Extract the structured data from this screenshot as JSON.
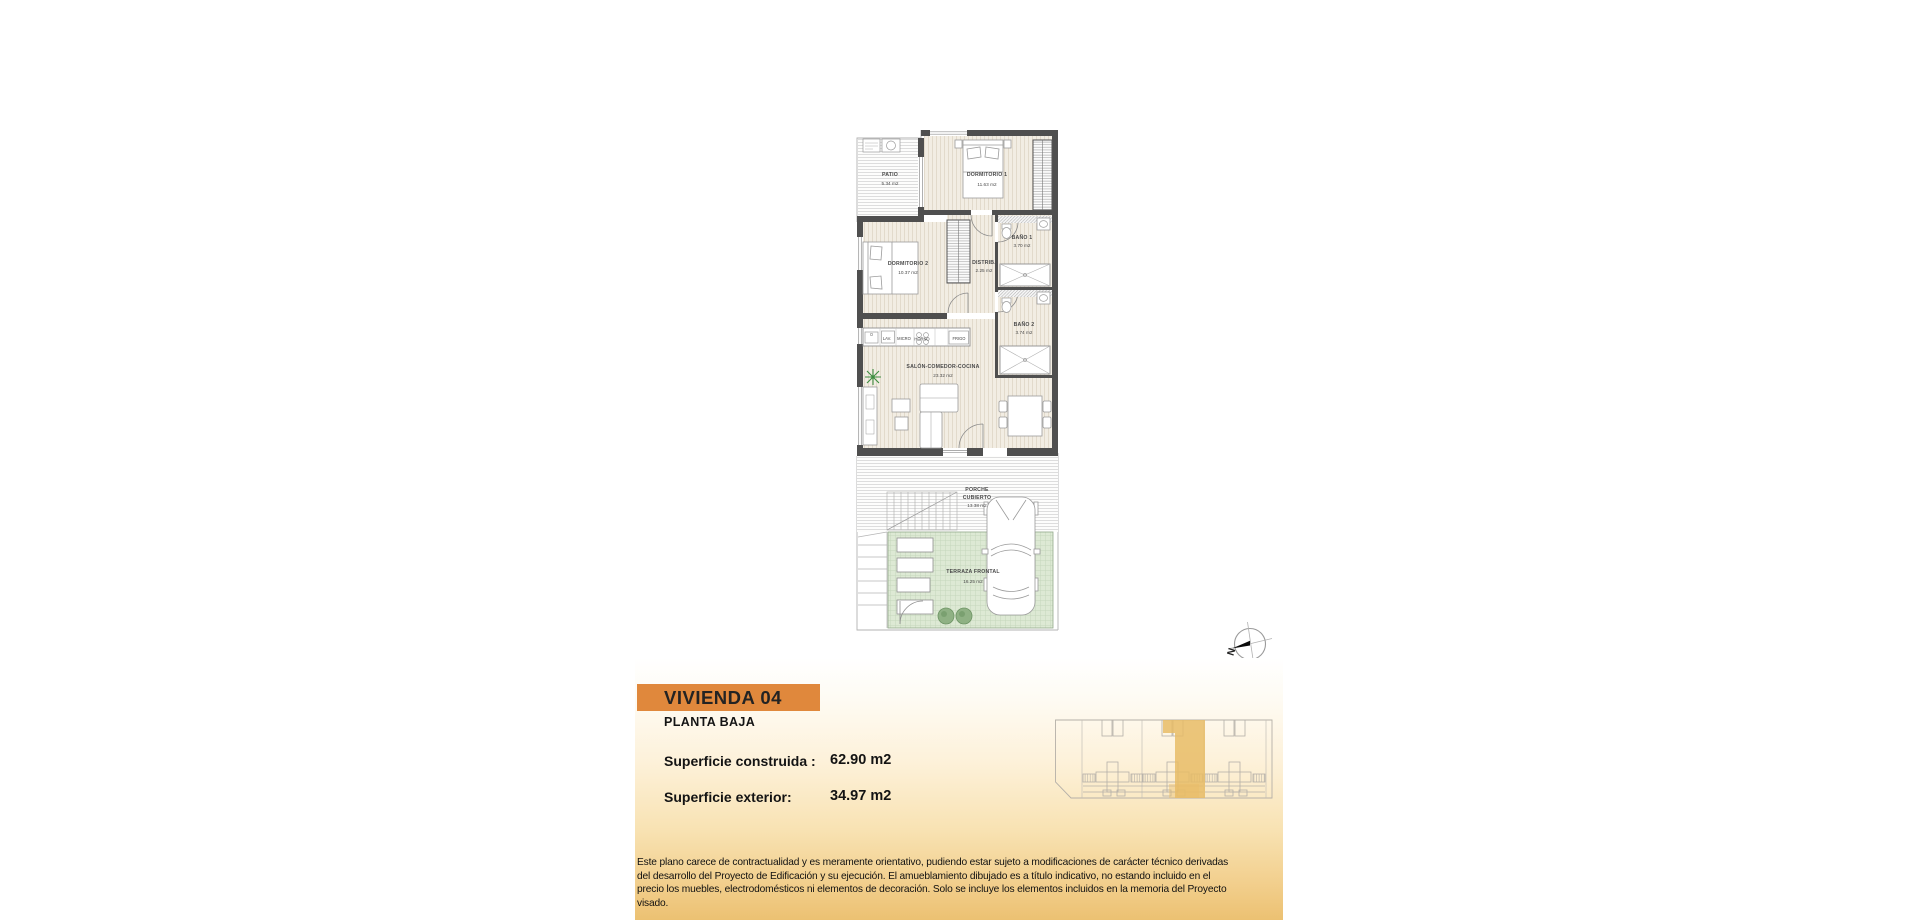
{
  "title_block": {
    "unit": "VIVIENDA 04",
    "floor": "PLANTA BAJA",
    "built_label": "Superficie construida :",
    "built_value": "62.90 m2",
    "exterior_label": "Superficie exterior:",
    "exterior_value": "34.97 m2"
  },
  "scale_label": "Escala 1: 100",
  "compass": {
    "north": "N"
  },
  "disclaimer": {
    "lines": [
      "Este plano carece de contractualidad y es meramente orientativo, pudiendo estar sujeto a modificaciones de carácter técnico derivadas",
      "del desarrollo del Proyecto de Edificación y su ejecución. El amueblamiento dibujado es a título indicativo, no estando incluido en el",
      "precio los muebles, electrodomésticos ni elementos de decoración. Solo se incluye los elementos incluidos en la memoria del Proyecto",
      "visado."
    ]
  },
  "plan": {
    "rooms": {
      "patio": {
        "name": "PATIO",
        "area": "5.34 m2"
      },
      "dorm1": {
        "name": "DORMITORIO 1",
        "area": "11.63 m2"
      },
      "bano1": {
        "name": "BAÑO 1",
        "area": "3.70 m2"
      },
      "distrib": {
        "name": "DISTRIB.",
        "area": "2.25 m2"
      },
      "dorm2": {
        "name": "DORMITORIO 2",
        "area": "10.37 m2"
      },
      "bano2": {
        "name": "BAÑO 2",
        "area": "3.74 m2"
      },
      "salon": {
        "name": "SALÓN-COMEDOR-COCINA",
        "area": "23.32 m2"
      },
      "porche": {
        "line1": "PORCHE",
        "line2": "CUBIERTO",
        "area": "13.38 m2"
      },
      "terraza": {
        "name": "TERRAZA FRONTAL",
        "area": "16.25 m2"
      }
    },
    "kitchen": {
      "lav": "LAV.",
      "micro": "MICRO",
      "horno": "HORNO",
      "frigo": "FRIGO"
    }
  },
  "colors": {
    "accent_orange": "#e0883c",
    "panel_gradient_bottom": "#ecc172",
    "thumbnail_highlight": "#e8bc66",
    "terrace_green": "#dde9d4",
    "wall_gray": "#4f4f4f"
  }
}
